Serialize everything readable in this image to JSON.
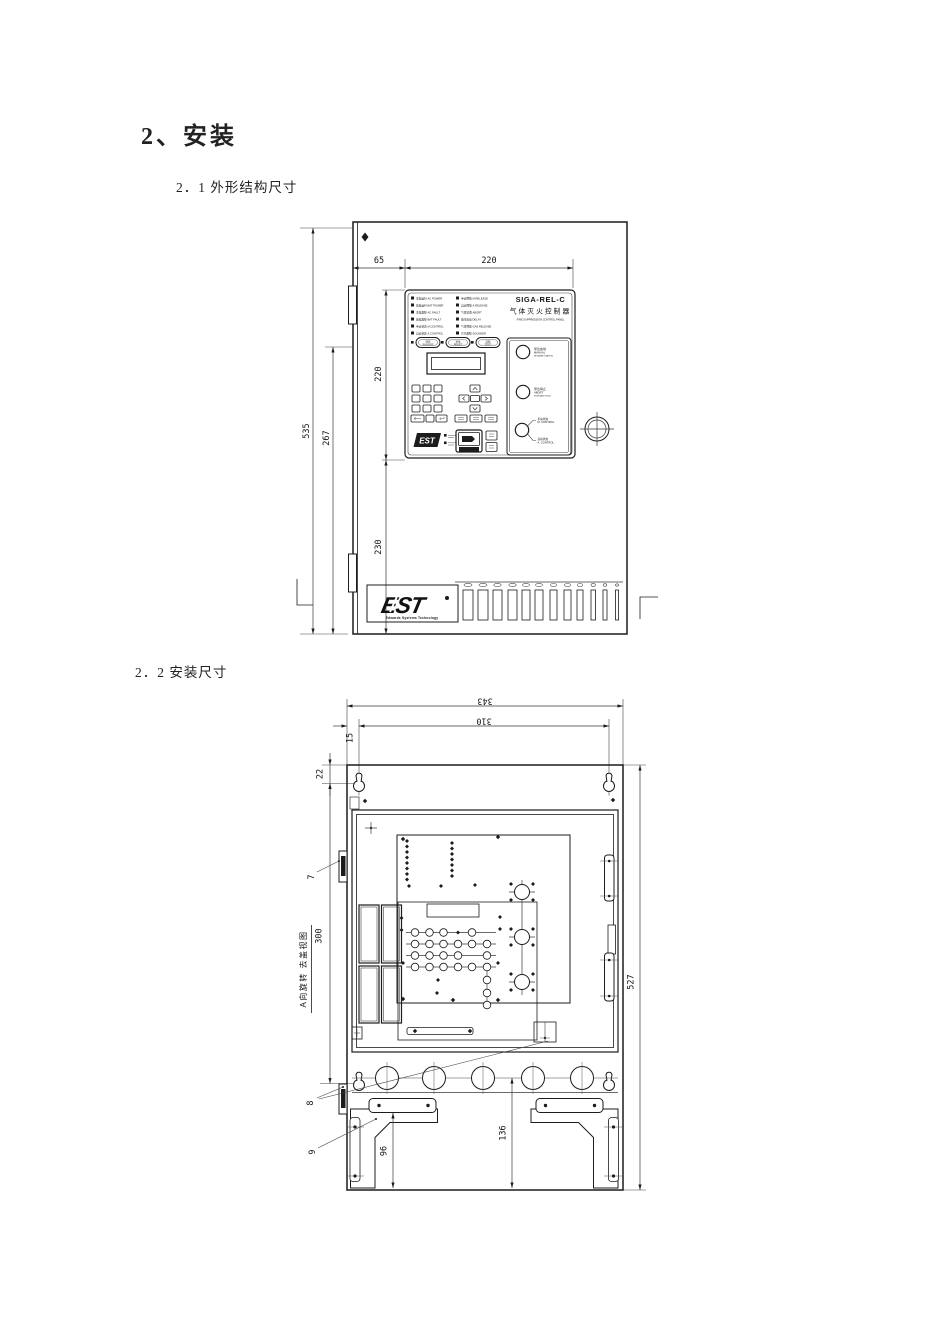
{
  "page": {
    "heading": "2、安装",
    "section1": "2．1 外形结构尺寸",
    "section2": "2．2 安装尺寸"
  },
  "drawing1": {
    "dims": {
      "offset_left": "65",
      "panel_width": "220",
      "total_height": "535",
      "inner_height": "267",
      "panel_height": "220",
      "lower_height": "230"
    },
    "panel": {
      "model": "SIGA-REL-C",
      "name_cn": "气体灭火控制器",
      "name_en": "FIRE SUPPRESSION CONTROL PANEL",
      "leds_left": [
        "主电运行 AC POWER",
        "备电运行 BAT POWER",
        "主电故障 AC FAULT",
        "备电故障 BAT FAULT",
        "手动状态 M.CONTROL",
        "自动状态 A.CONTROL"
      ],
      "leds_right": [
        "手动释放 M.RELEASE",
        "自动释放 A.RELEASE",
        "气体喷洒 ABORT",
        "延时启动 DELAY",
        "气体释放 GAS RELEASE",
        "声光故障 SOUNDER"
      ],
      "func_buttons": [
        [
          "消音",
          "SILENCE"
        ],
        [
          "复位",
          "RESET"
        ],
        [
          "自检",
          "TEST"
        ]
      ],
      "btn_release": [
        "紧急启动",
        "MANUAL",
        "RELEASE STATION"
      ],
      "btn_abort": [
        "紧急停止",
        "ABORT",
        "PUSH AND HOLD"
      ],
      "switch_manual": [
        "手动状态",
        "M. CONTROL"
      ],
      "switch_auto": [
        "自动状态",
        "A. CONTROL"
      ]
    },
    "logo": {
      "est": "EST",
      "company": "Edwards Systems Technology",
      "est_small": "EST"
    }
  },
  "drawing2": {
    "view_label": "A向旋转 去盖视图",
    "dims": {
      "total_width": "343",
      "hole_width": "310",
      "edge_offset": "15",
      "top_offset": "22",
      "hole_height": "300",
      "total_height": "527",
      "bracket_height": "96",
      "knockout_height": "136"
    },
    "callouts": [
      "7",
      "8",
      "9"
    ]
  }
}
